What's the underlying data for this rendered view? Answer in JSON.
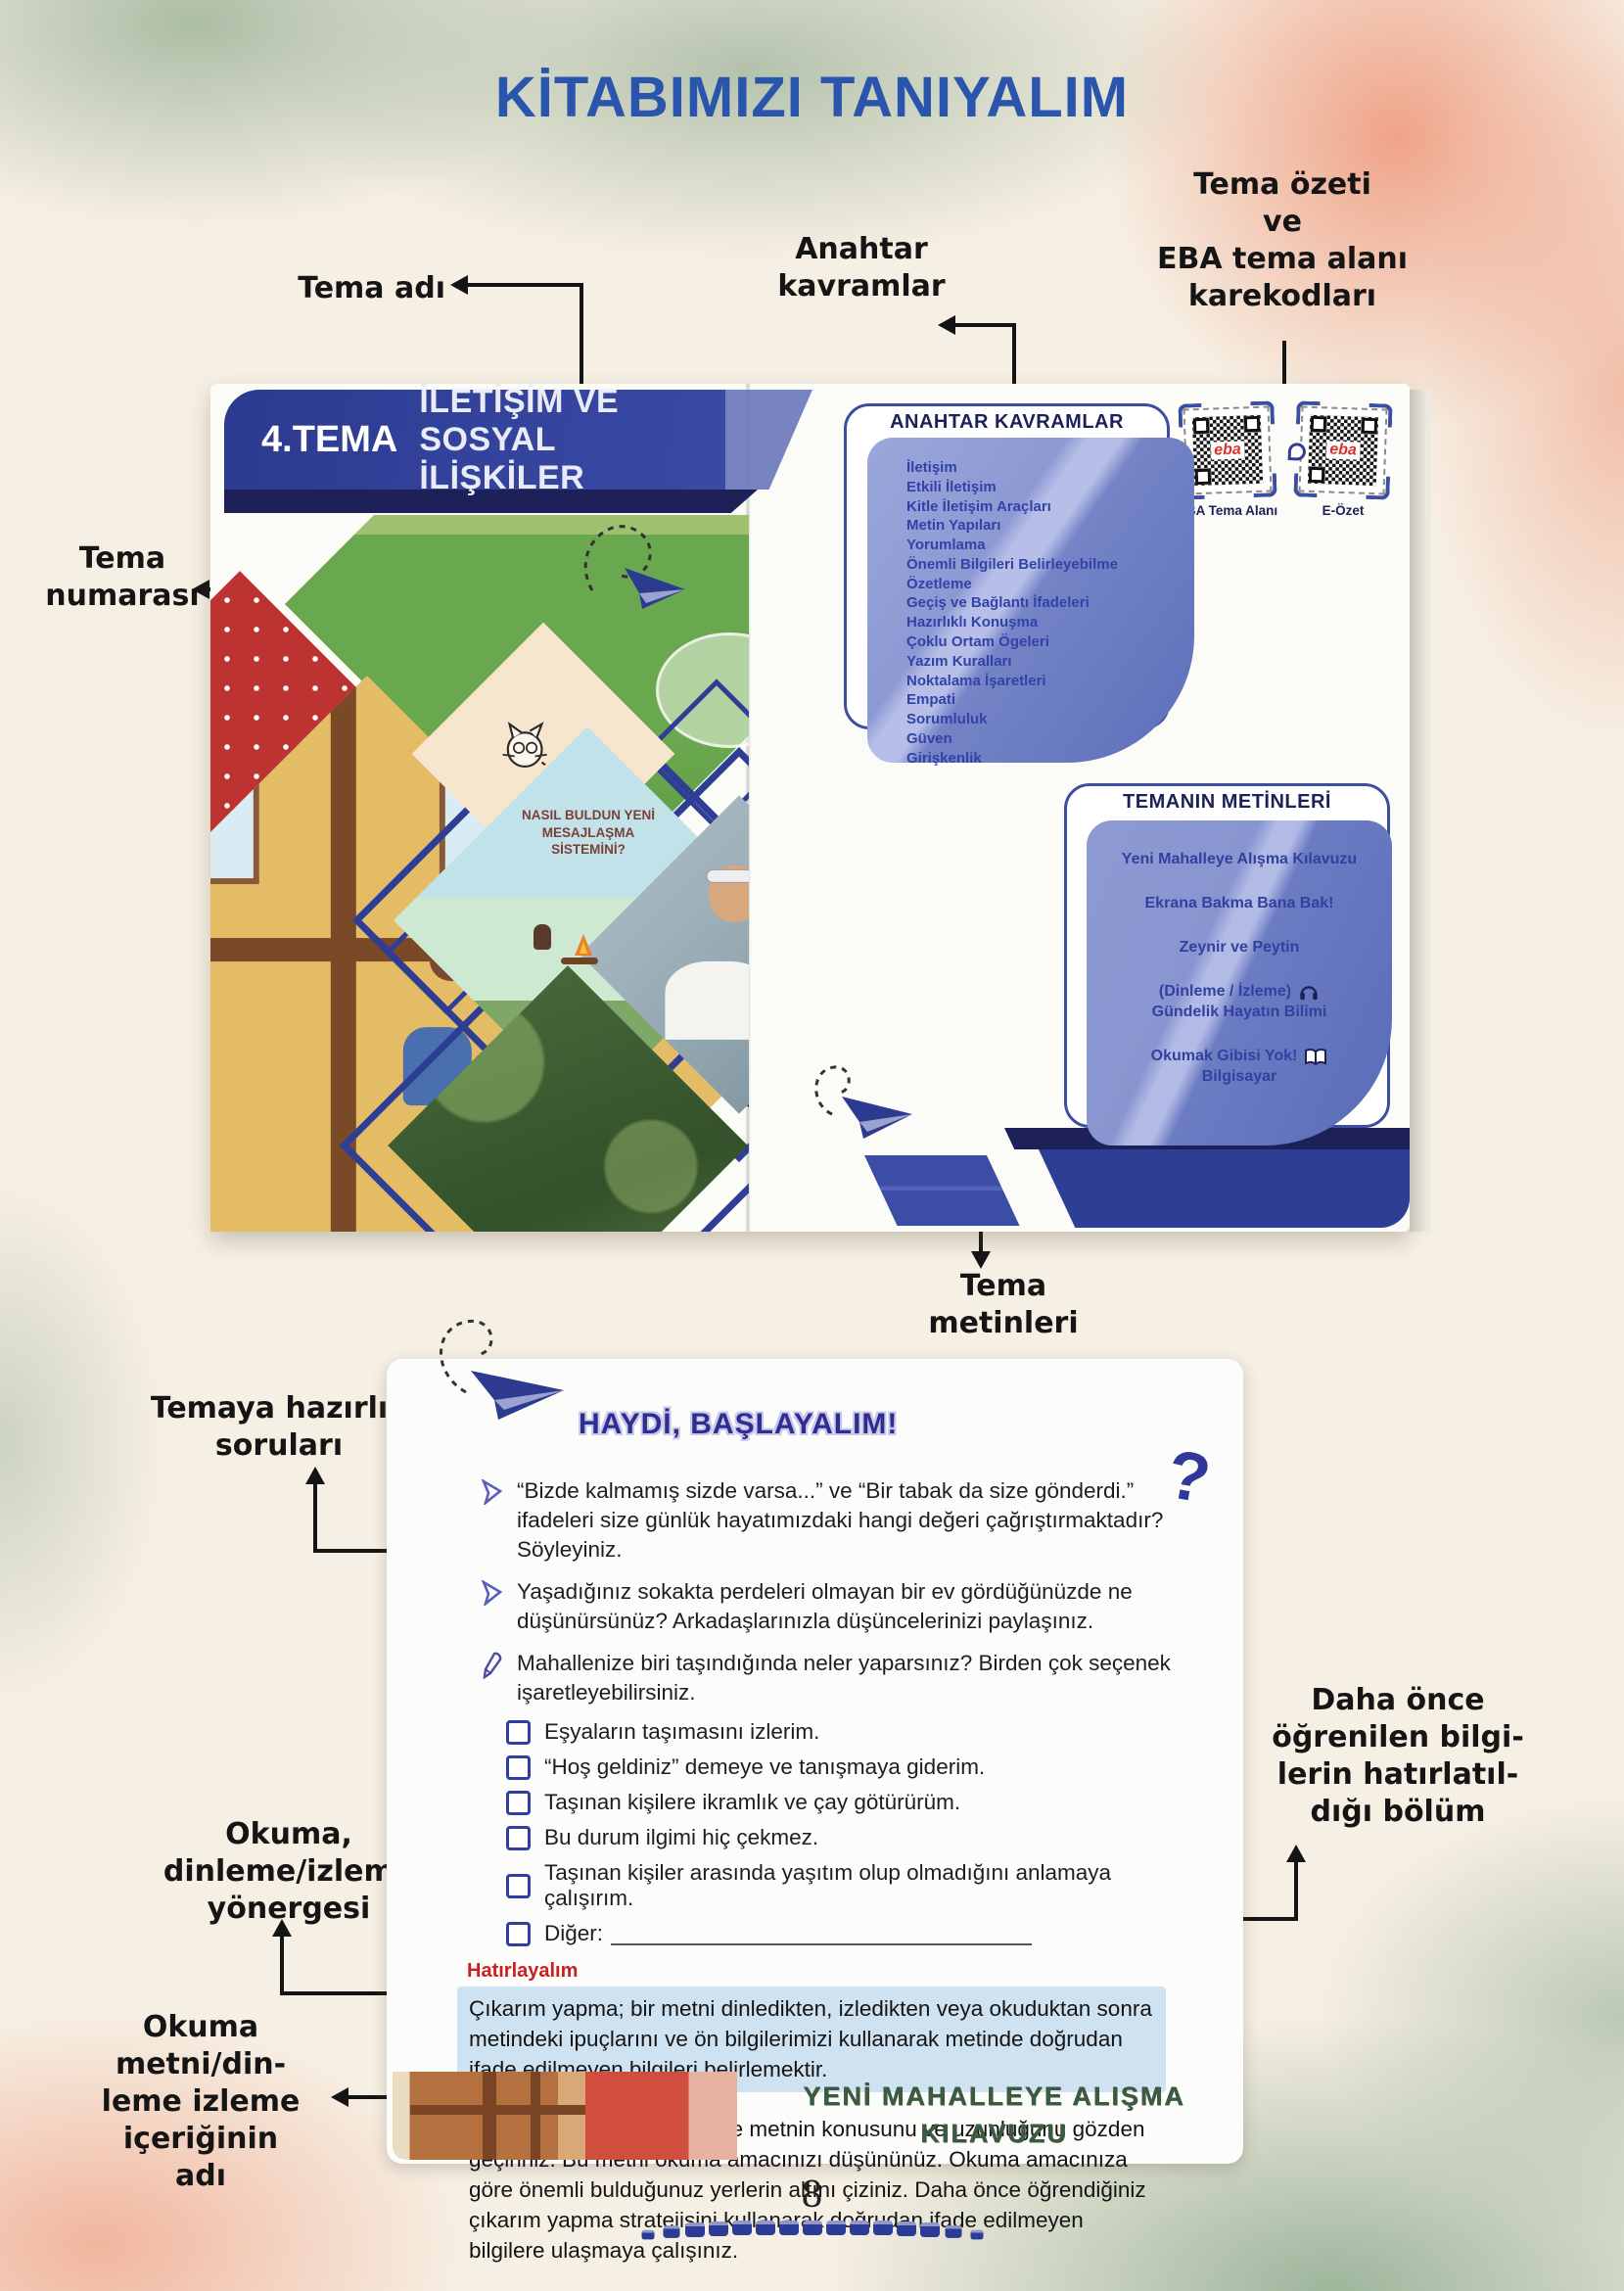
{
  "page": {
    "title": "KİTABIMIZI TANIYALIM",
    "page_number": "8"
  },
  "colors": {
    "title_blue": "#2956ac",
    "banner_blue": "#2e3e95",
    "navy": "#1d2158",
    "panel_blue": "#7d89cb",
    "panel_text_blue": "#3342a8",
    "eba_red": "#d7312c",
    "remember_red": "#cc2020",
    "highlight_blue": "#cfe2f1",
    "reading_green": "#3c5a40"
  },
  "annotations": {
    "theme_name": "Tema adı",
    "key_concepts": "Anahtar\nkavramlar",
    "theme_summary": "Tema özeti\nve\nEBA tema alanı\nkarekodları",
    "theme_number": "Tema\nnumarası",
    "theme_texts": "Tema\nmetinleri",
    "prep_questions": "Temaya hazırlık\nsoruları",
    "reading_directive": "Okuma,\ndinleme/izleme\nyönergesi",
    "reading_content_name": "Okuma\nmetni/din-\nleme izleme\niçeriğinin\nadı",
    "prior_knowledge": "Daha önce\nöğrenilen bilgi-\nlerin hatırlatıl-\ndığı bölüm"
  },
  "book": {
    "left_page": {
      "theme_number_label": "4.TEMA",
      "theme_title": "İLETİŞİM VE SOSYAL İLİŞKİLER",
      "collage_caption": "NASIL BULDUN YENİ\nMESAJLAŞMA\nSİSTEMİNİ?"
    },
    "right_page": {
      "key_concepts_title": "ANAHTAR KAVRAMLAR",
      "key_concepts": [
        "İletişim",
        "Etkili İletişim",
        "Kitle İletişim Araçları",
        "Metin Yapıları",
        "Yorumlama",
        "Önemli Bilgileri Belirleyebilme",
        "Özetleme",
        "Geçiş ve Bağlantı İfadeleri",
        "Hazırlıklı Konuşma",
        "Çoklu Ortam Ögeleri",
        "Yazım Kuralları",
        "Noktalama İşaretleri",
        "Empati",
        "Sorumluluk",
        "Güven",
        "Girişkenlik"
      ],
      "qr_codes": [
        {
          "label": "EBA Tema Alanı",
          "brand": "eba"
        },
        {
          "label": "E-Özet",
          "brand": "eba"
        }
      ],
      "texts_title": "TEMANIN METİNLERİ",
      "text_items": [
        {
          "title": "Yeni Mahalleye Alışma Kılavuzu"
        },
        {
          "title": "Ekrana Bakma Bana Bak!"
        },
        {
          "title": "Zeynir ve Peytin"
        },
        {
          "title": "(Dinleme / İzleme)",
          "subtitle": "Gündelik Hayatın Bilimi",
          "icon": "headphones"
        },
        {
          "title": "Okumak Gibisi Yok!",
          "subtitle": "Bilgisayar",
          "icon": "open-book"
        }
      ]
    }
  },
  "worksheet": {
    "heading": "HAYDİ, BAŞLAYALIM!",
    "questions": [
      {
        "icon": "chevron",
        "text": "“Bizde kalmamış sizde varsa...” ve “Bir tabak da size gönderdi.” ifadeleri size günlük hayatımızdaki hangi değeri çağrıştırmaktadır? Söyleyiniz."
      },
      {
        "icon": "chevron",
        "text": "Yaşadığınız sokakta perdeleri olmayan bir ev gördüğünüzde ne düşünürsünüz? Arkadaşlarınızla düşüncelerinizi paylaşınız."
      },
      {
        "icon": "pen",
        "text": "Mahallenize biri taşındığında neler yaparsınız? Birden çok seçenek işaretleyebilirsiniz."
      }
    ],
    "options": [
      "Eşyaların taşımasını izlerim.",
      "“Hoş geldiniz” demeye ve tanışmaya giderim.",
      "Taşınan kişilere ikramlık ve çay götürürüm.",
      "Bu durum ilgimi hiç çekmez.",
      "Taşınan kişiler arasında yaşıtım olup olmadığını anlamaya çalışırım.",
      "Diğer:"
    ],
    "remember_title": "Hatırlayalım",
    "remember_text": "Çıkarım yapma; bir metni dinledikten, izledikten veya okuduktan sonra metindeki ipuçlarını ve ön bilgilerimizi kullanarak metinde doğrudan ifade edilmeyen bilgileri belirlemektir.",
    "instruction_text": "Okumaya başlamadan önce metnin konusunu ve uzunluğunu gözden geçiriniz. Bu metni okuma amacınızı düşününüz. Okuma amacınıza göre önemli bulduğunuz yerlerin altını çiziniz. Daha önce öğrendiğiniz çıkarım yapma stratejisini kullanarak doğrudan ifade edilmeyen bilgilere ulaşmaya çalışınız.",
    "reading_title": "YENİ MAHALLEYE ALIŞMA\nKILAVUZU"
  }
}
